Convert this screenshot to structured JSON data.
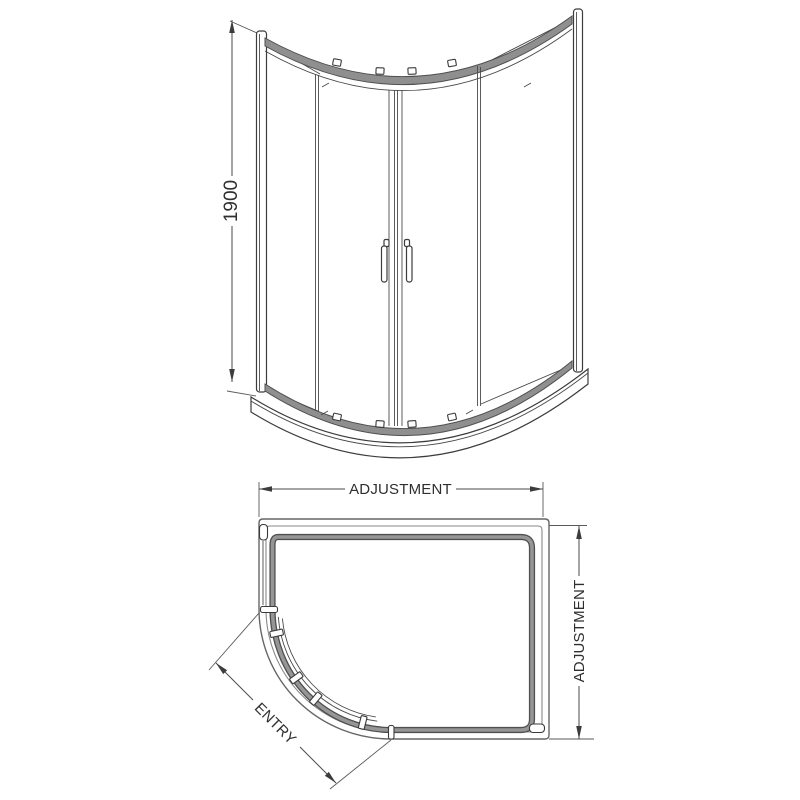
{
  "drawing": {
    "subject": "offset-quadrant-shower-enclosure-technical-drawing",
    "colors": {
      "background": "#ffffff",
      "line": "#3c3c3c",
      "frame_band": "#8f8f8f",
      "text": "#2f2f2f"
    },
    "front_elevation": {
      "height_dimension": "1900"
    },
    "plan_view": {
      "width_dimension_label": "ADJUSTMENT",
      "depth_dimension_label": "ADJUSTMENT",
      "entry_label": "ENTRY"
    }
  }
}
